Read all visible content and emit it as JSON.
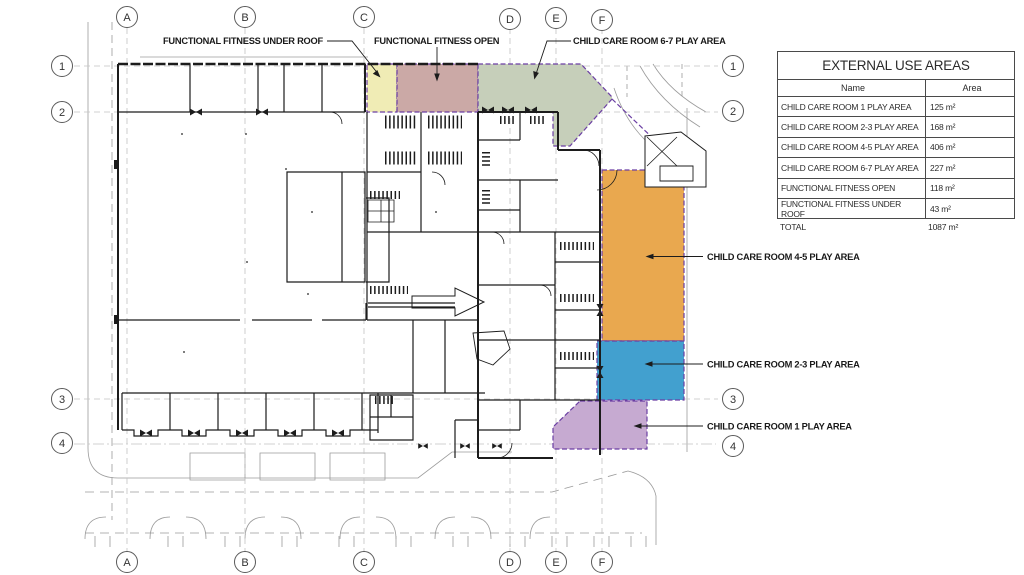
{
  "grid": {
    "columns": [
      "A",
      "B",
      "C",
      "D",
      "E",
      "F"
    ],
    "rows": [
      "1",
      "2",
      "3",
      "4"
    ]
  },
  "annotations": {
    "ff_under_roof": "FUNCTIONAL FITNESS UNDER ROOF",
    "ff_open": "FUNCTIONAL FITNESS OPEN",
    "cc_67": "CHILD CARE ROOM 6-7 PLAY AREA",
    "cc_45": "CHILD CARE ROOM 4-5 PLAY AREA",
    "cc_23": "CHILD CARE ROOM 2-3 PLAY AREA",
    "cc_1": "CHILD CARE ROOM 1 PLAY AREA"
  },
  "zones": [
    {
      "id": "ff_under_roof",
      "name": "FUNCTIONAL FITNESS UNDER ROOF",
      "color": "#F0ECB5"
    },
    {
      "id": "ff_open",
      "name": "FUNCTIONAL FITNESS OPEN",
      "color": "#CBA9A6"
    },
    {
      "id": "cc_67",
      "name": "CHILD CARE ROOM 6-7 PLAY AREA",
      "color": "#C6CFBA"
    },
    {
      "id": "cc_45",
      "name": "CHILD CARE ROOM 4-5 PLAY AREA",
      "color": "#E9A84F"
    },
    {
      "id": "cc_23",
      "name": "CHILD CARE ROOM 2-3 PLAY AREA",
      "color": "#42A0CF"
    },
    {
      "id": "cc_1",
      "name": "CHILD CARE ROOM 1 PLAY AREA",
      "color": "#C6AAD1"
    }
  ],
  "zone_border_color": "#6B3FA3",
  "table": {
    "title": "EXTERNAL USE AREAS",
    "columns": [
      "Name",
      "Area"
    ],
    "rows": [
      [
        "CHILD CARE ROOM 1 PLAY AREA",
        "125 m²"
      ],
      [
        "CHILD CARE ROOM 2-3 PLAY AREA",
        "168 m²"
      ],
      [
        "CHILD CARE ROOM 4-5 PLAY AREA",
        "406 m²"
      ],
      [
        "CHILD CARE ROOM 6-7 PLAY AREA",
        "227 m²"
      ],
      [
        "FUNCTIONAL FITNESS OPEN",
        "118 m²"
      ],
      [
        "FUNCTIONAL FITNESS UNDER ROOF",
        "43 m²"
      ]
    ],
    "total": [
      "TOTAL",
      "1087 m²"
    ]
  }
}
